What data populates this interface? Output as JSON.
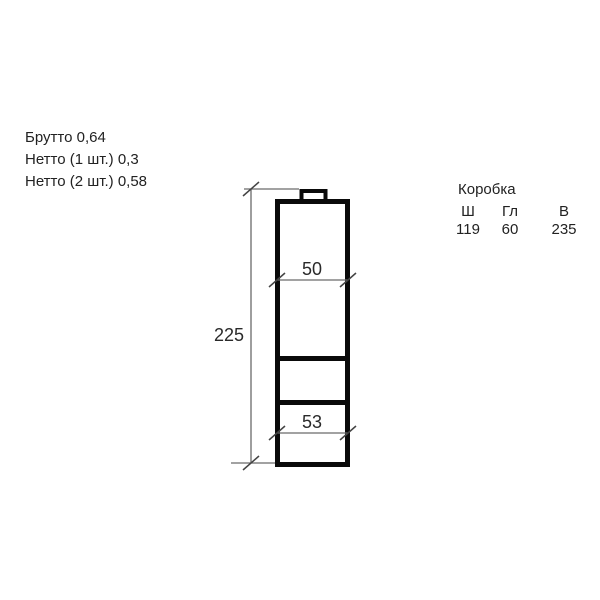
{
  "weights": {
    "gross": "Брутто 0,64",
    "net_1pc": "Нетто (1 шт.) 0,3",
    "net_2pc": "Нетто (2 шт.) 0,58"
  },
  "box_table": {
    "title": "Коробка",
    "columns": [
      "Ш",
      "Гл",
      "В"
    ],
    "values": [
      "119",
      "60",
      "235"
    ]
  },
  "drawing": {
    "height_label": "225",
    "upper_width_label": "50",
    "lower_width_label": "53",
    "outline_color": "#0a0a0a",
    "dimension_line_color": "#6a6a6a"
  }
}
